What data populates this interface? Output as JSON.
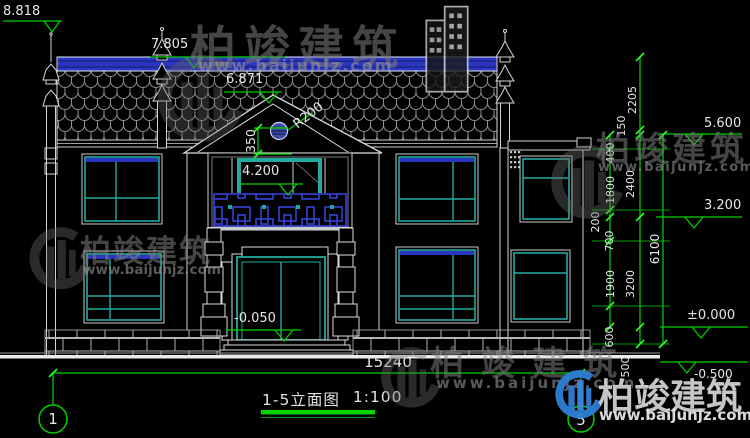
{
  "drawing": {
    "title": "1-5立面图",
    "scale": "1:100",
    "axis_labels": {
      "left": "1",
      "right": "5"
    },
    "overall_width": "15240",
    "elevation_marks": {
      "roof_finial": "8.818",
      "ridge": "7.805",
      "gable_apex": "6.871",
      "balcony_floor": "4.200",
      "entrance": "-0.050",
      "eave_right": "5.600",
      "second_floor_right": "3.200",
      "ground_right": "±0.000",
      "below_ground_right": "-0.500"
    },
    "radius_note": "R200",
    "offset_note": "350",
    "dim_chain": {
      "c2205": "2205",
      "c150": "150",
      "c400": "400",
      "c2400": "2400",
      "c1800": "1800",
      "c200": "200",
      "c700": "700",
      "c6100": "6100",
      "c1900": "1900",
      "c3200": "3200",
      "c600": "600",
      "c500": "500"
    }
  },
  "watermark": {
    "brand": "柏竣建筑",
    "url": "www.baijunjz.com"
  },
  "colors": {
    "background": "#000000",
    "line_white": "#d6d6d6",
    "dimension_green": "#00d400",
    "window_teal": "#23aaa0",
    "ridge_blue": "#2a35c0",
    "lattice_blue": "#3542d6"
  }
}
